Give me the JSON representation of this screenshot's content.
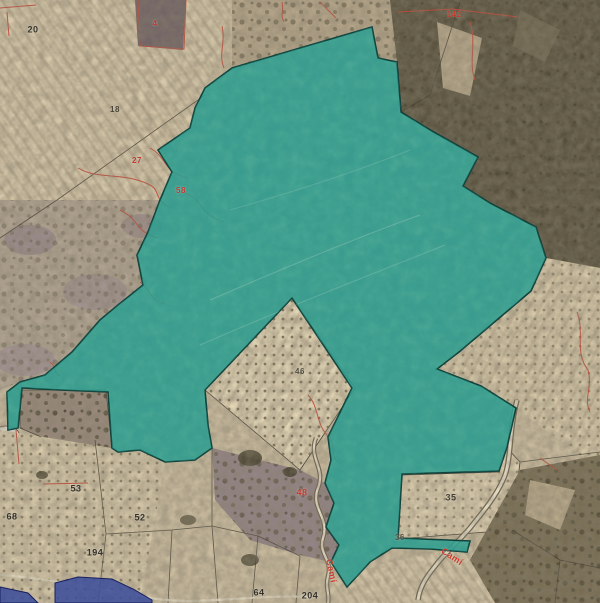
{
  "map": {
    "colors": {
      "selection_fill": "#2aa493",
      "selection_outline": "#0e3f38",
      "highlight_blue": "#3e4e9b",
      "cadastral_red": "#c94434",
      "boundary_dark": "#3b372c"
    },
    "labels": [
      {
        "kind": "parcel-number-label",
        "text": "20",
        "x": 33,
        "y": 30,
        "color": "#38342a",
        "size": 9
      },
      {
        "kind": "parcel-number-label",
        "text": "18",
        "x": 115,
        "y": 110,
        "color": "#4a4336",
        "size": 8
      },
      {
        "kind": "parcel-number-label",
        "text": "4",
        "x": 155,
        "y": 24,
        "color": "#c23b2e",
        "size": 8
      },
      {
        "kind": "parcel-number-label",
        "text": "142",
        "x": 454,
        "y": 15,
        "color": "#c23b2e",
        "size": 8
      },
      {
        "kind": "parcel-number-label",
        "text": "27",
        "x": 137,
        "y": 161,
        "color": "#c23b2e",
        "size": 8
      },
      {
        "kind": "parcel-number-label",
        "text": "58",
        "x": 181,
        "y": 191,
        "color": "#c23b2e",
        "size": 8
      },
      {
        "kind": "parcel-number-label",
        "text": "46",
        "x": 300,
        "y": 372,
        "color": "#55503f",
        "size": 8
      },
      {
        "kind": "parcel-number-label",
        "text": "48",
        "x": 302,
        "y": 493,
        "color": "#c23b2e",
        "size": 9
      },
      {
        "kind": "parcel-number-label",
        "text": "53",
        "x": 76,
        "y": 489,
        "color": "#35312a",
        "size": 9
      },
      {
        "kind": "parcel-number-label",
        "text": "68",
        "x": 12,
        "y": 517,
        "color": "#35312a",
        "size": 9
      },
      {
        "kind": "parcel-number-label",
        "text": "52",
        "x": 140,
        "y": 518,
        "color": "#35312a",
        "size": 9
      },
      {
        "kind": "parcel-number-label",
        "text": "194",
        "x": 95,
        "y": 553,
        "color": "#35312a",
        "size": 9
      },
      {
        "kind": "parcel-number-label",
        "text": "64",
        "x": 259,
        "y": 593,
        "color": "#35312a",
        "size": 9
      },
      {
        "kind": "parcel-number-label",
        "text": "204",
        "x": 310,
        "y": 596,
        "color": "#35312a",
        "size": 9
      },
      {
        "kind": "parcel-number-label",
        "text": "35",
        "x": 451,
        "y": 498,
        "color": "#454033",
        "size": 9
      },
      {
        "kind": "parcel-number-label",
        "text": "36",
        "x": 400,
        "y": 538,
        "color": "#55503f",
        "size": 8
      },
      {
        "kind": "road-name-label",
        "text": "Camí",
        "x": 331,
        "y": 571,
        "color": "#cc3b2a",
        "size": 9,
        "rotate": 78
      },
      {
        "kind": "road-name-label",
        "text": "Camí",
        "x": 452,
        "y": 557,
        "color": "#cc3b2a",
        "size": 9,
        "rotate": 33
      }
    ]
  }
}
